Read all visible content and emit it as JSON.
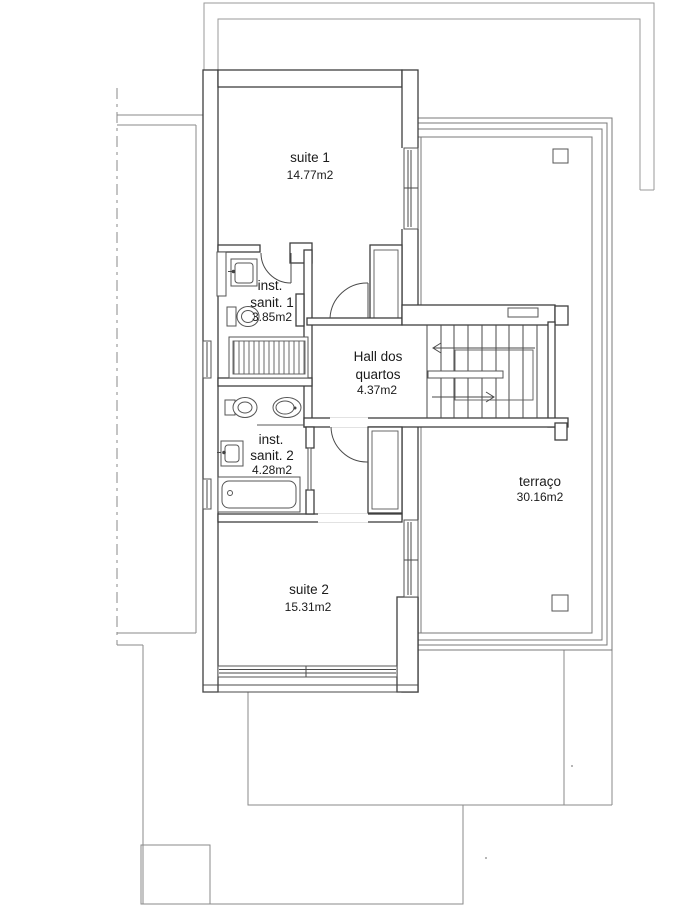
{
  "plan": {
    "type": "residential-floor-plan-scan",
    "rooms": {
      "suite1": {
        "name": "suite 1",
        "area": "14.77m2"
      },
      "sanit1": {
        "line1": "inst.",
        "line2": "sanit. 1",
        "area": "3.85m2"
      },
      "hall": {
        "line1": "Hall dos",
        "line2": "quartos",
        "area": "4.37m2"
      },
      "sanit2": {
        "line1": "inst.",
        "line2": "sanit. 2",
        "area": "4.28m2"
      },
      "suite2": {
        "name": "suite 2",
        "area": "15.31m2"
      },
      "terraco": {
        "name": "terraço",
        "area": "30.16m2"
      }
    },
    "icons": {
      "bathroom1": [
        "storage-cabinet",
        "washbasin",
        "toilet",
        "shower"
      ],
      "bathroom2": [
        "bidet",
        "toilet",
        "washbasin",
        "bathtub"
      ],
      "stairs": "staircase",
      "stair_arrows": [
        "up-direction-arrow",
        "down-direction-arrow"
      ]
    },
    "colors": {
      "paper": "#ffffff",
      "wall_line": "#3e3e3e",
      "light_line": "#8a8a8a",
      "text": "#1b1b1b"
    }
  }
}
